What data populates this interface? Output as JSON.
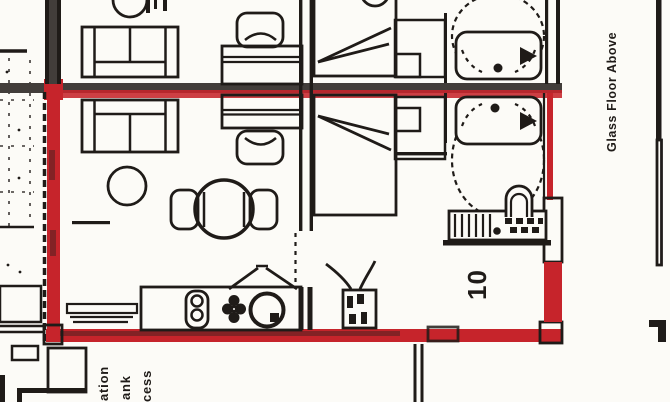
{
  "annotations": {
    "glass_floor_above": "Glass Floor Above",
    "unit_number": "10",
    "clipped_labels": [
      "ation",
      "ank",
      "cess"
    ]
  },
  "colors": {
    "highlight_red": "#c6242b",
    "wall_dark": "#423d3a",
    "ink": "#1f1b18",
    "background": "#fcfbf7"
  }
}
